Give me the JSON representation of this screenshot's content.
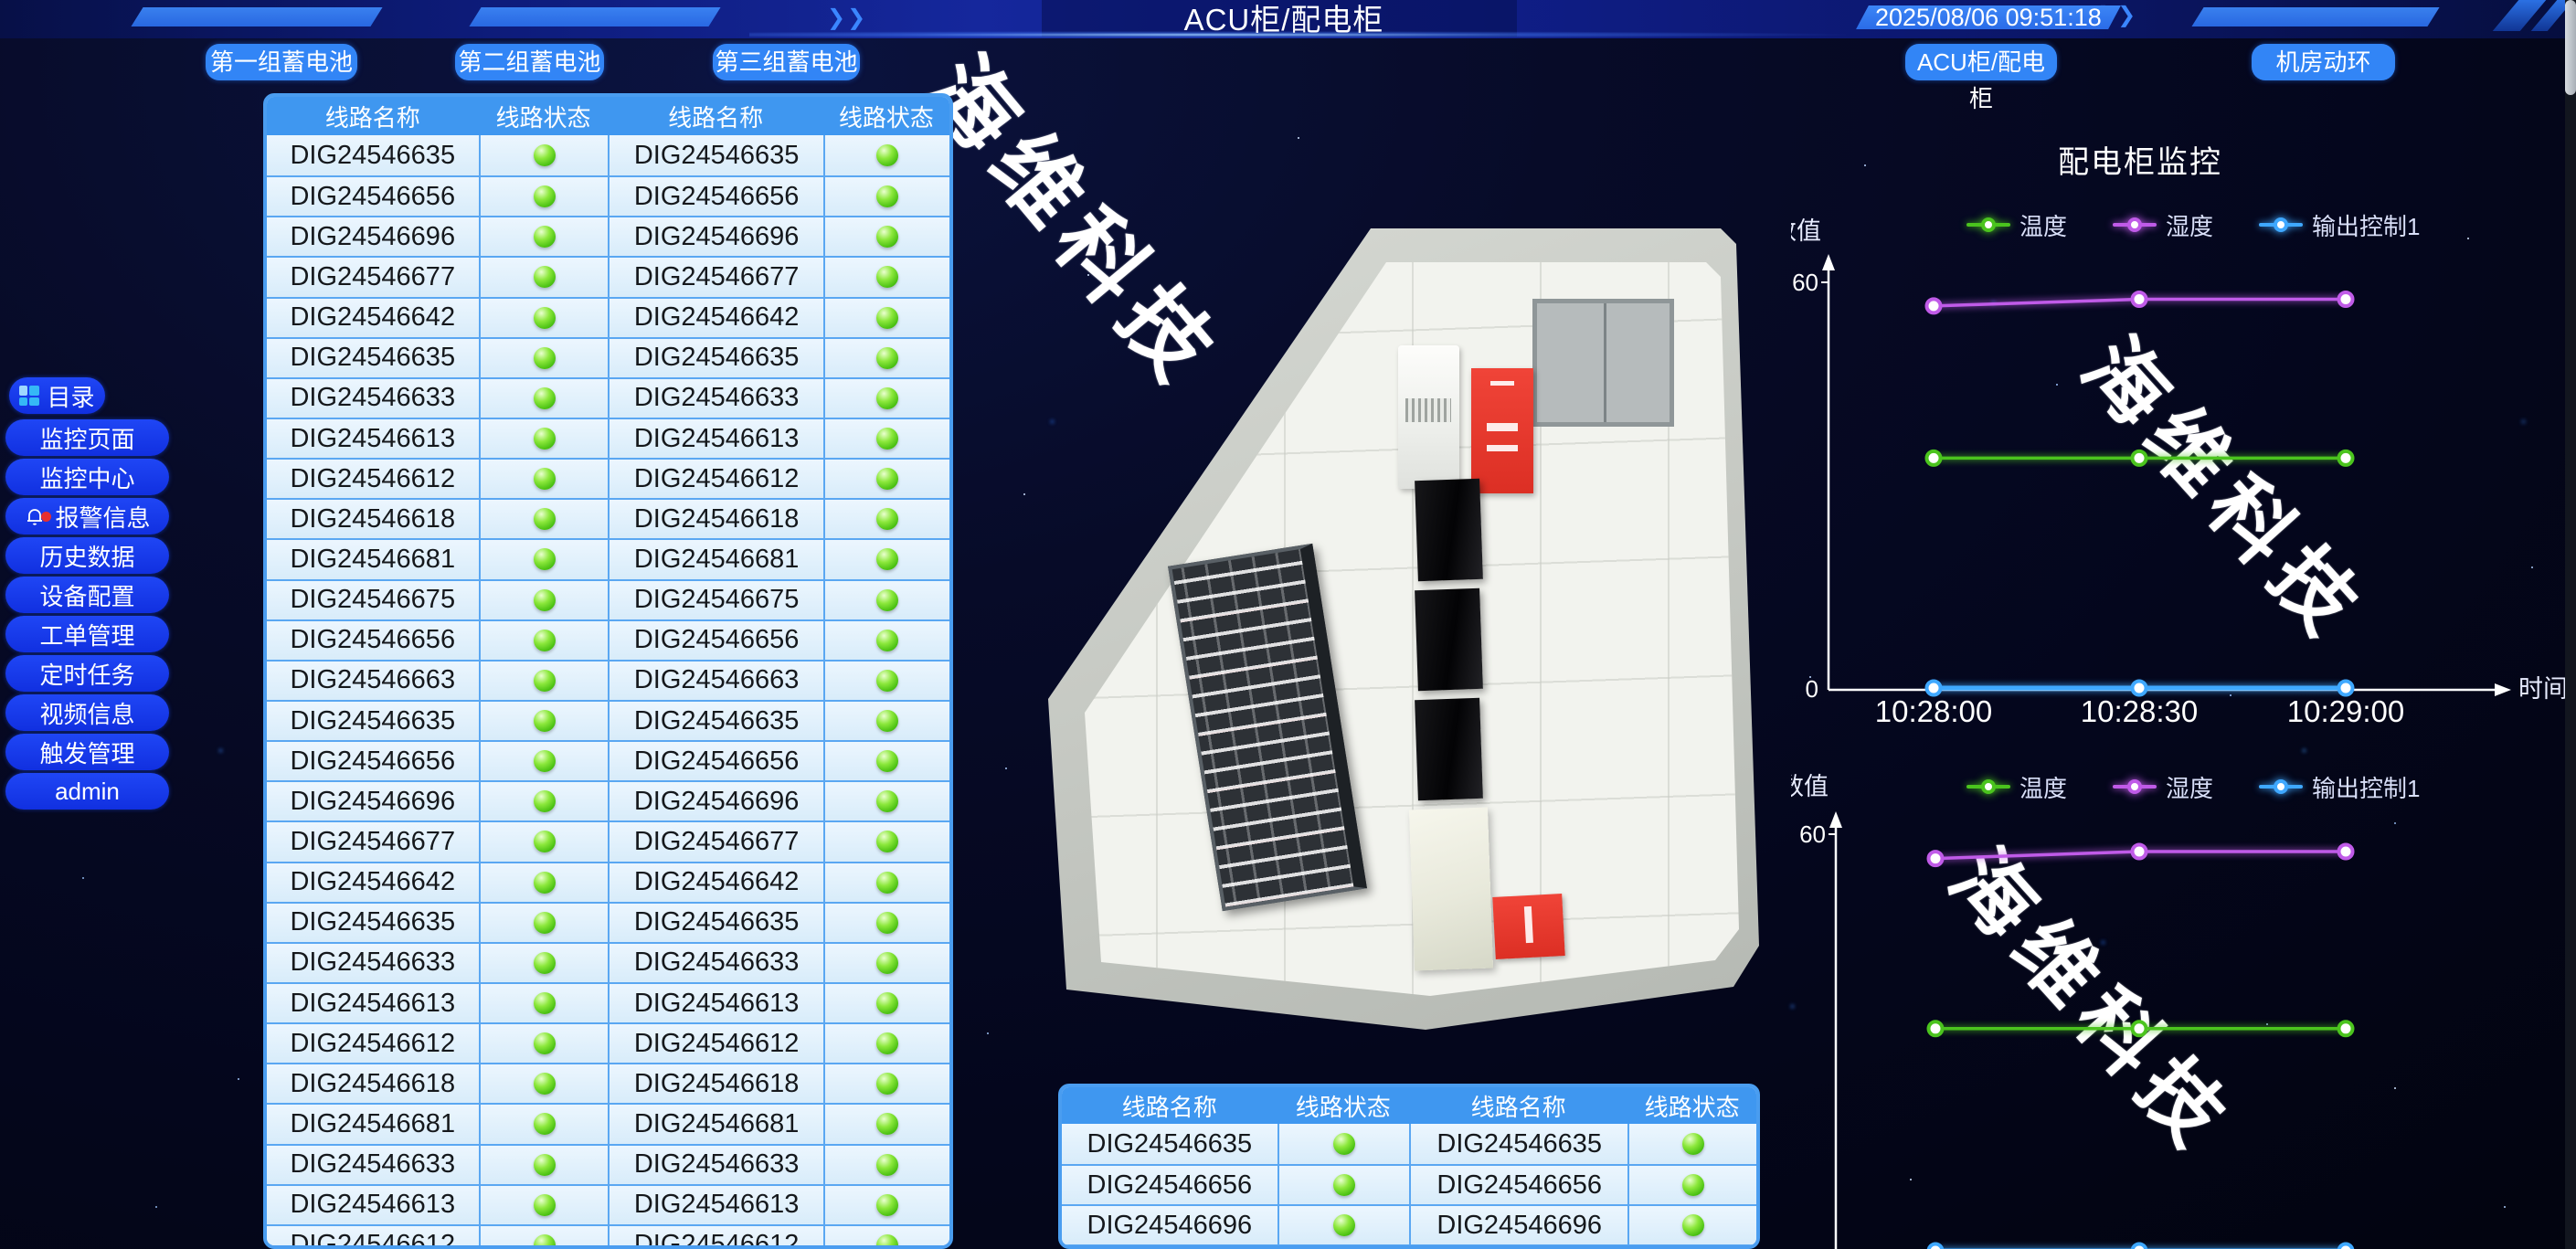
{
  "header": {
    "title": "ACU柜/配电柜",
    "timestamp": "2025/08/06 09:51:18",
    "battery_buttons": [
      "第一组蓄电池",
      "第二组蓄电池",
      "第三组蓄电池"
    ],
    "nav_buttons": [
      "ACU柜/配电柜",
      "机房动环"
    ]
  },
  "sidebar": {
    "items": [
      {
        "label": "目录",
        "icon": "menu-grid-icon"
      },
      {
        "label": "监控页面"
      },
      {
        "label": "监控中心"
      },
      {
        "label": "报警信息",
        "icon": "bell-icon",
        "alert_badge": true
      },
      {
        "label": "历史数据"
      },
      {
        "label": "设备配置"
      },
      {
        "label": "工单管理"
      },
      {
        "label": "定时任务"
      },
      {
        "label": "视频信息"
      },
      {
        "label": "触发管理"
      },
      {
        "label": "admin"
      }
    ]
  },
  "tables": {
    "headers": [
      "线路名称",
      "线路状态",
      "线路名称",
      "线路状态"
    ],
    "status_ok_color": "#4cc214",
    "main_rows": [
      "DIG24546635",
      "DIG24546656",
      "DIG24546696",
      "DIG24546677",
      "DIG24546642",
      "DIG24546635",
      "DIG24546633",
      "DIG24546613",
      "DIG24546612",
      "DIG24546618",
      "DIG24546681",
      "DIG24546675",
      "DIG24546656",
      "DIG24546663",
      "DIG24546635",
      "DIG24546656",
      "DIG24546696",
      "DIG24546677",
      "DIG24546642",
      "DIG24546635",
      "DIG24546633",
      "DIG24546613",
      "DIG24546612",
      "DIG24546618",
      "DIG24546681",
      "DIG24546633",
      "DIG24546613",
      "DIG24546612"
    ],
    "bottom_rows": [
      "DIG24546635",
      "DIG24546656",
      "DIG24546696",
      ""
    ]
  },
  "charts": {
    "title": "配电柜监控",
    "y_axis_label": "数值",
    "x_axis_label": "时间",
    "y_max_tick": "60",
    "y_min_tick": "0",
    "legend": [
      {
        "label": "温度",
        "color": "#4bc41e"
      },
      {
        "label": "湿度",
        "color": "#c05be8"
      },
      {
        "label": "输出控制1",
        "color": "#3fa8ff"
      }
    ],
    "chart_data": [
      {
        "type": "line",
        "x": [
          "10:28:00",
          "10:28:30",
          "10:29:00"
        ],
        "ylim": [
          0,
          60
        ],
        "x_axis_visible": true,
        "series": [
          {
            "name": "温度",
            "values": [
              34,
              34,
              34
            ]
          },
          {
            "name": "湿度",
            "values": [
              56.5,
              57.5,
              57.5
            ]
          },
          {
            "name": "输出控制1",
            "values": [
              0,
              0,
              0
            ]
          }
        ]
      },
      {
        "type": "line",
        "x": [
          "10:28:00",
          "10:28:30",
          "10:29:00"
        ],
        "ylim": [
          0,
          60
        ],
        "x_axis_visible": false,
        "series": [
          {
            "name": "温度",
            "values": [
              32,
              32,
              32
            ]
          },
          {
            "name": "湿度",
            "values": [
              56.5,
              57.5,
              57.5
            ]
          },
          {
            "name": "输出控制1",
            "values": [
              0,
              0,
              0
            ]
          }
        ]
      }
    ]
  },
  "watermark": {
    "text": "海维科技"
  }
}
